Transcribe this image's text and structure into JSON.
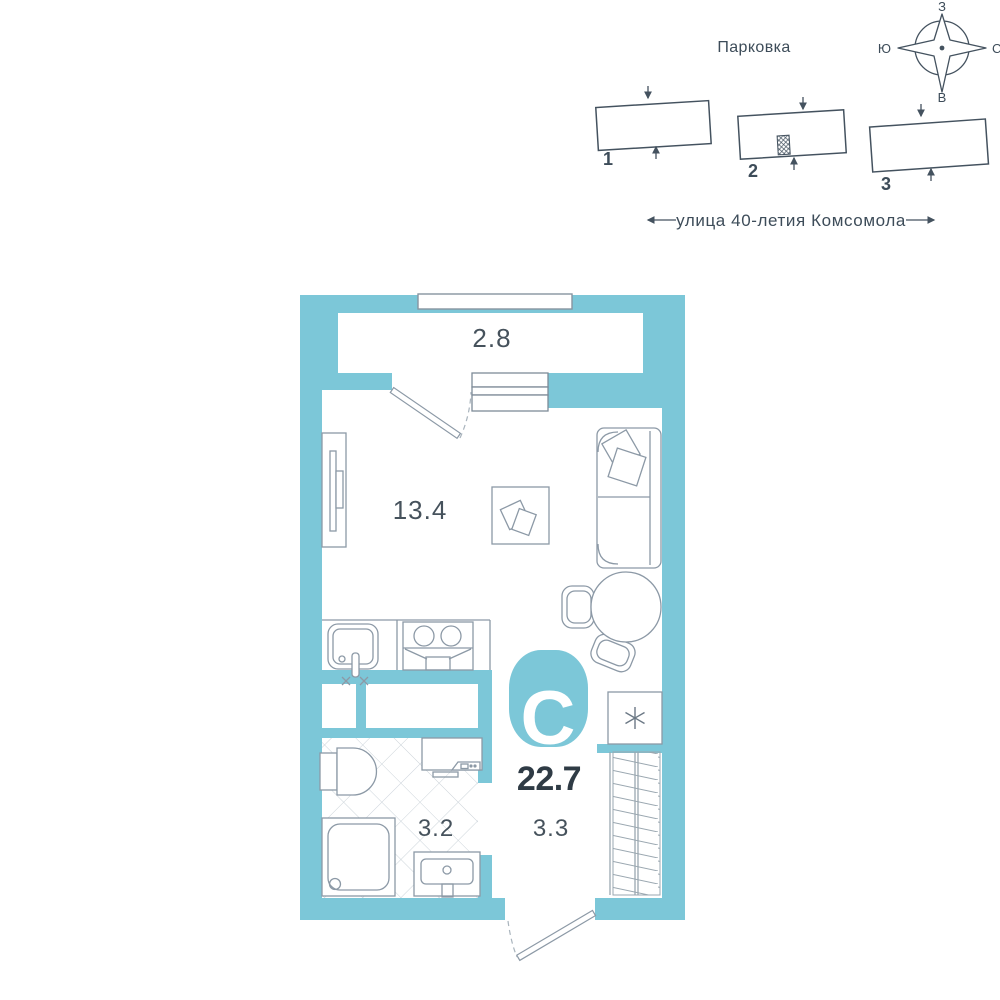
{
  "colors": {
    "accent_teal": "#7cc7d8",
    "ink": "#3d4c59",
    "furniture_line": "#8c99a6",
    "tile_line": "#ccd4da"
  },
  "site_plan": {
    "parking_label": "Парковка",
    "street_label": "улица 40-летия Комсомола",
    "compass": {
      "top": "З",
      "left": "Ю",
      "right": "С",
      "bottom": "В"
    },
    "buildings": [
      {
        "number": "1"
      },
      {
        "number": "2",
        "note": "apartment-location-marker"
      },
      {
        "number": "3"
      }
    ]
  },
  "floor_plan": {
    "type_badge": "С",
    "total_area": "22.7",
    "rooms": {
      "balcony": "2.8",
      "living": "13.4",
      "bathroom": "3.2",
      "hallway": "3.3"
    },
    "symbols": {
      "fridge": "asterisk-in-square"
    }
  }
}
